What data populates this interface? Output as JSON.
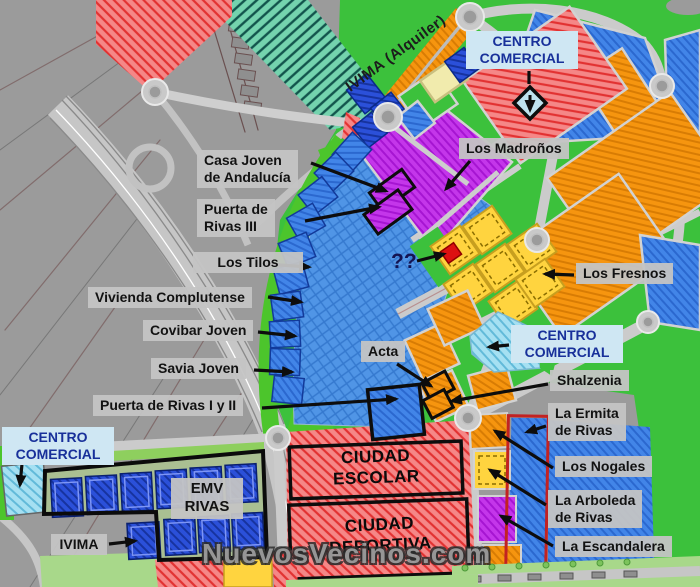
{
  "map": {
    "labels": {
      "casa_joven": "Casa Joven\nde Andalucía",
      "puerta_rivas_3": "Puerta de\nRivas III",
      "los_tilos": "Los Tilos",
      "vivienda_complutense": "Vivienda Complutense",
      "covibar_joven": "Covibar Joven",
      "savia_joven": "Savia Joven",
      "puerta_rivas_1_2": "Puerta de Rivas I y II",
      "acta": "Acta",
      "shalzenia": "Shalzenia",
      "la_ermita": "La Ermita\nde Rivas",
      "los_nogales": "Los Nogales",
      "la_arboleda": "La Arboleda\nde Rivas",
      "la_escandalera": "La Escandalera",
      "los_madronos": "Los Madroños",
      "los_fresnos": "Los Fresnos",
      "centro_comercial": "CENTRO\nCOMERCIAL",
      "emv_rivas": "EMV\nRIVAS",
      "ivima": "IVIMA",
      "ivima_alquiler": "IVIMA (Alquiler)",
      "unknown_parcel": "??",
      "ciudad_escolar": "CIUDAD\nESCOLAR",
      "ciudad_deportiva": "CIUDAD\nDEPORTIVA"
    },
    "watermark": "NuevosVecinos.com",
    "colors": {
      "label_bg": "#c4c4c4",
      "cc_label_bg": "#cfe7f3",
      "cc_label_text": "#18309a",
      "arrow": "#0d0d0d",
      "background_gray": "#9b9b9b",
      "green": "#3cc13c",
      "teal_corridor": "#74d3ae",
      "red_zone": "#f58787",
      "orange_parcel": "#f6950f",
      "purple_parcel": "#c436ea",
      "yellow_parcel": "#ffd43f",
      "blue_parcel": "#4285e8",
      "navy_parcel": "#2b50d9",
      "cyan_commercial": "#a5e0f2",
      "superblock_blue": "#5095e6",
      "red_outline": "#c22222"
    }
  }
}
